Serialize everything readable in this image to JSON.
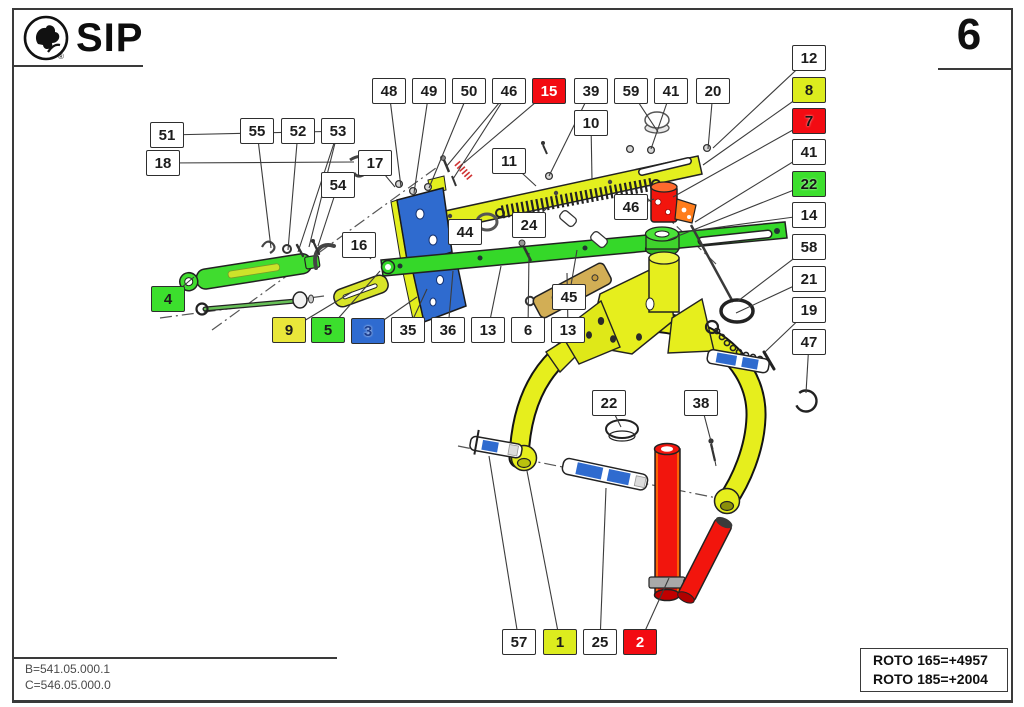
{
  "header": {
    "brand": "SIP",
    "registered_mark": "®",
    "page_number": "6"
  },
  "footer": {
    "b_code": "B=541.05.000.1",
    "c_code": "C=546.05.000.0",
    "roto_165": "ROTO 165=+4957",
    "roto_185": "ROTO 185=+2004"
  },
  "colors": {
    "red": "#f30b12",
    "chartreuse": "#dcec1e",
    "green": "#3cdf2d",
    "yellow": "#e9e73a",
    "blue": "#2f6bd0",
    "box_border": "#2e2e2e",
    "leader": "#3c3c3c"
  },
  "callouts": [
    {
      "label": "48",
      "x": 372,
      "y": 78,
      "targets": [
        [
          401,
          187
        ]
      ]
    },
    {
      "label": "49",
      "x": 412,
      "y": 78,
      "targets": [
        [
          414,
          193
        ]
      ]
    },
    {
      "label": "50",
      "x": 452,
      "y": 78,
      "targets": [
        [
          429,
          188
        ]
      ]
    },
    {
      "label": "46",
      "x": 492,
      "y": 78,
      "targets": [
        [
          446,
          167
        ],
        [
          453,
          179
        ]
      ]
    },
    {
      "label": "15",
      "x": 532,
      "y": 78,
      "bg": "red",
      "fg": "light",
      "targets": [
        [
          464,
          163
        ]
      ]
    },
    {
      "label": "39",
      "x": 574,
      "y": 78,
      "targets": [
        [
          549,
          176
        ]
      ]
    },
    {
      "label": "59",
      "x": 614,
      "y": 78,
      "targets": [
        [
          658,
          132
        ]
      ]
    },
    {
      "label": "41",
      "x": 654,
      "y": 78,
      "targets": [
        [
          651,
          149
        ]
      ]
    },
    {
      "label": "20",
      "x": 696,
      "y": 78,
      "targets": [
        [
          708,
          149
        ]
      ]
    },
    {
      "label": "10",
      "x": 574,
      "y": 110,
      "targets": [
        [
          592,
          180
        ]
      ]
    },
    {
      "label": "11",
      "x": 492,
      "y": 148,
      "targets": [
        [
          536,
          186
        ]
      ]
    },
    {
      "label": "17",
      "x": 358,
      "y": 150,
      "targets": [
        [
          395,
          187
        ]
      ]
    },
    {
      "label": "51",
      "x": 150,
      "y": 122,
      "targets": [
        [
          348,
          131
        ]
      ]
    },
    {
      "label": "18",
      "x": 146,
      "y": 150,
      "targets": [
        [
          354,
          162
        ]
      ]
    },
    {
      "label": "55",
      "x": 240,
      "y": 118,
      "targets": [
        [
          271,
          248
        ]
      ]
    },
    {
      "label": "52",
      "x": 281,
      "y": 118,
      "targets": [
        [
          288,
          250
        ]
      ]
    },
    {
      "label": "53",
      "x": 321,
      "y": 118,
      "targets": [
        [
          298,
          252
        ],
        [
          309,
          247
        ]
      ]
    },
    {
      "label": "54",
      "x": 321,
      "y": 172,
      "targets": [
        [
          318,
          246
        ]
      ]
    },
    {
      "label": "16",
      "x": 342,
      "y": 232,
      "targets": [
        [
          371,
          259
        ]
      ]
    },
    {
      "label": "4",
      "x": 151,
      "y": 286,
      "bg": "green",
      "targets": [
        [
          194,
          277
        ]
      ]
    },
    {
      "label": "9",
      "x": 272,
      "y": 317,
      "bg": "yellow",
      "targets": [
        [
          352,
          292
        ]
      ]
    },
    {
      "label": "5",
      "x": 311,
      "y": 317,
      "bg": "green",
      "targets": [
        [
          380,
          271
        ]
      ]
    },
    {
      "label": "3",
      "x": 351,
      "y": 318,
      "bg": "blue",
      "fg": "outline",
      "targets": [
        [
          417,
          297
        ]
      ]
    },
    {
      "label": "35",
      "x": 391,
      "y": 317,
      "targets": [
        [
          427,
          289
        ]
      ]
    },
    {
      "label": "36",
      "x": 431,
      "y": 317,
      "targets": [
        [
          453,
          271
        ]
      ]
    },
    {
      "label": "13",
      "x": 471,
      "y": 317,
      "targets": [
        [
          501,
          266
        ]
      ]
    },
    {
      "label": "6",
      "x": 511,
      "y": 317,
      "targets": [
        [
          529,
          253
        ]
      ]
    },
    {
      "label": "13",
      "x": 551,
      "y": 317,
      "targets": [
        [
          567,
          273
        ]
      ]
    },
    {
      "label": "44",
      "x": 448,
      "y": 219,
      "targets": [
        [
          482,
          219
        ]
      ]
    },
    {
      "label": "24",
      "x": 512,
      "y": 212,
      "targets": [
        [
          547,
          208
        ]
      ]
    },
    {
      "label": "46",
      "x": 614,
      "y": 194,
      "targets": [
        [
          654,
          199
        ]
      ]
    },
    {
      "label": "45",
      "x": 552,
      "y": 284,
      "targets": [
        [
          577,
          250
        ]
      ]
    },
    {
      "label": "12",
      "x": 792,
      "y": 45,
      "targets": [
        [
          713,
          148
        ]
      ]
    },
    {
      "label": "8",
      "x": 792,
      "y": 77,
      "bg": "chartreuse",
      "targets": [
        [
          703,
          165
        ]
      ]
    },
    {
      "label": "7",
      "x": 792,
      "y": 108,
      "bg": "red",
      "fg": "dark",
      "targets": [
        [
          673,
          197
        ]
      ]
    },
    {
      "label": "41",
      "x": 792,
      "y": 139,
      "targets": [
        [
          695,
          222
        ]
      ]
    },
    {
      "label": "22",
      "x": 792,
      "y": 171,
      "bg": "green",
      "fg": "dark",
      "targets": [
        [
          668,
          240
        ]
      ]
    },
    {
      "label": "14",
      "x": 792,
      "y": 202,
      "targets": [
        [
          691,
          231
        ]
      ]
    },
    {
      "label": "58",
      "x": 792,
      "y": 234,
      "targets": [
        [
          738,
          301
        ]
      ]
    },
    {
      "label": "21",
      "x": 792,
      "y": 266,
      "targets": [
        [
          736,
          313
        ]
      ]
    },
    {
      "label": "19",
      "x": 792,
      "y": 297,
      "targets": [
        [
          765,
          352
        ]
      ]
    },
    {
      "label": "47",
      "x": 792,
      "y": 329,
      "targets": [
        [
          806,
          393
        ]
      ]
    },
    {
      "label": "22",
      "x": 592,
      "y": 390,
      "targets": [
        [
          621,
          427
        ]
      ]
    },
    {
      "label": "38",
      "x": 684,
      "y": 390,
      "targets": [
        [
          713,
          449
        ]
      ]
    },
    {
      "label": "57",
      "x": 502,
      "y": 629,
      "targets": [
        [
          489,
          456
        ]
      ]
    },
    {
      "label": "1",
      "x": 543,
      "y": 629,
      "bg": "chartreuse",
      "targets": [
        [
          527,
          471
        ]
      ]
    },
    {
      "label": "25",
      "x": 583,
      "y": 629,
      "targets": [
        [
          606,
          488
        ]
      ]
    },
    {
      "label": "2",
      "x": 623,
      "y": 629,
      "bg": "red",
      "fg": "light",
      "targets": [
        [
          669,
          578
        ]
      ]
    }
  ]
}
